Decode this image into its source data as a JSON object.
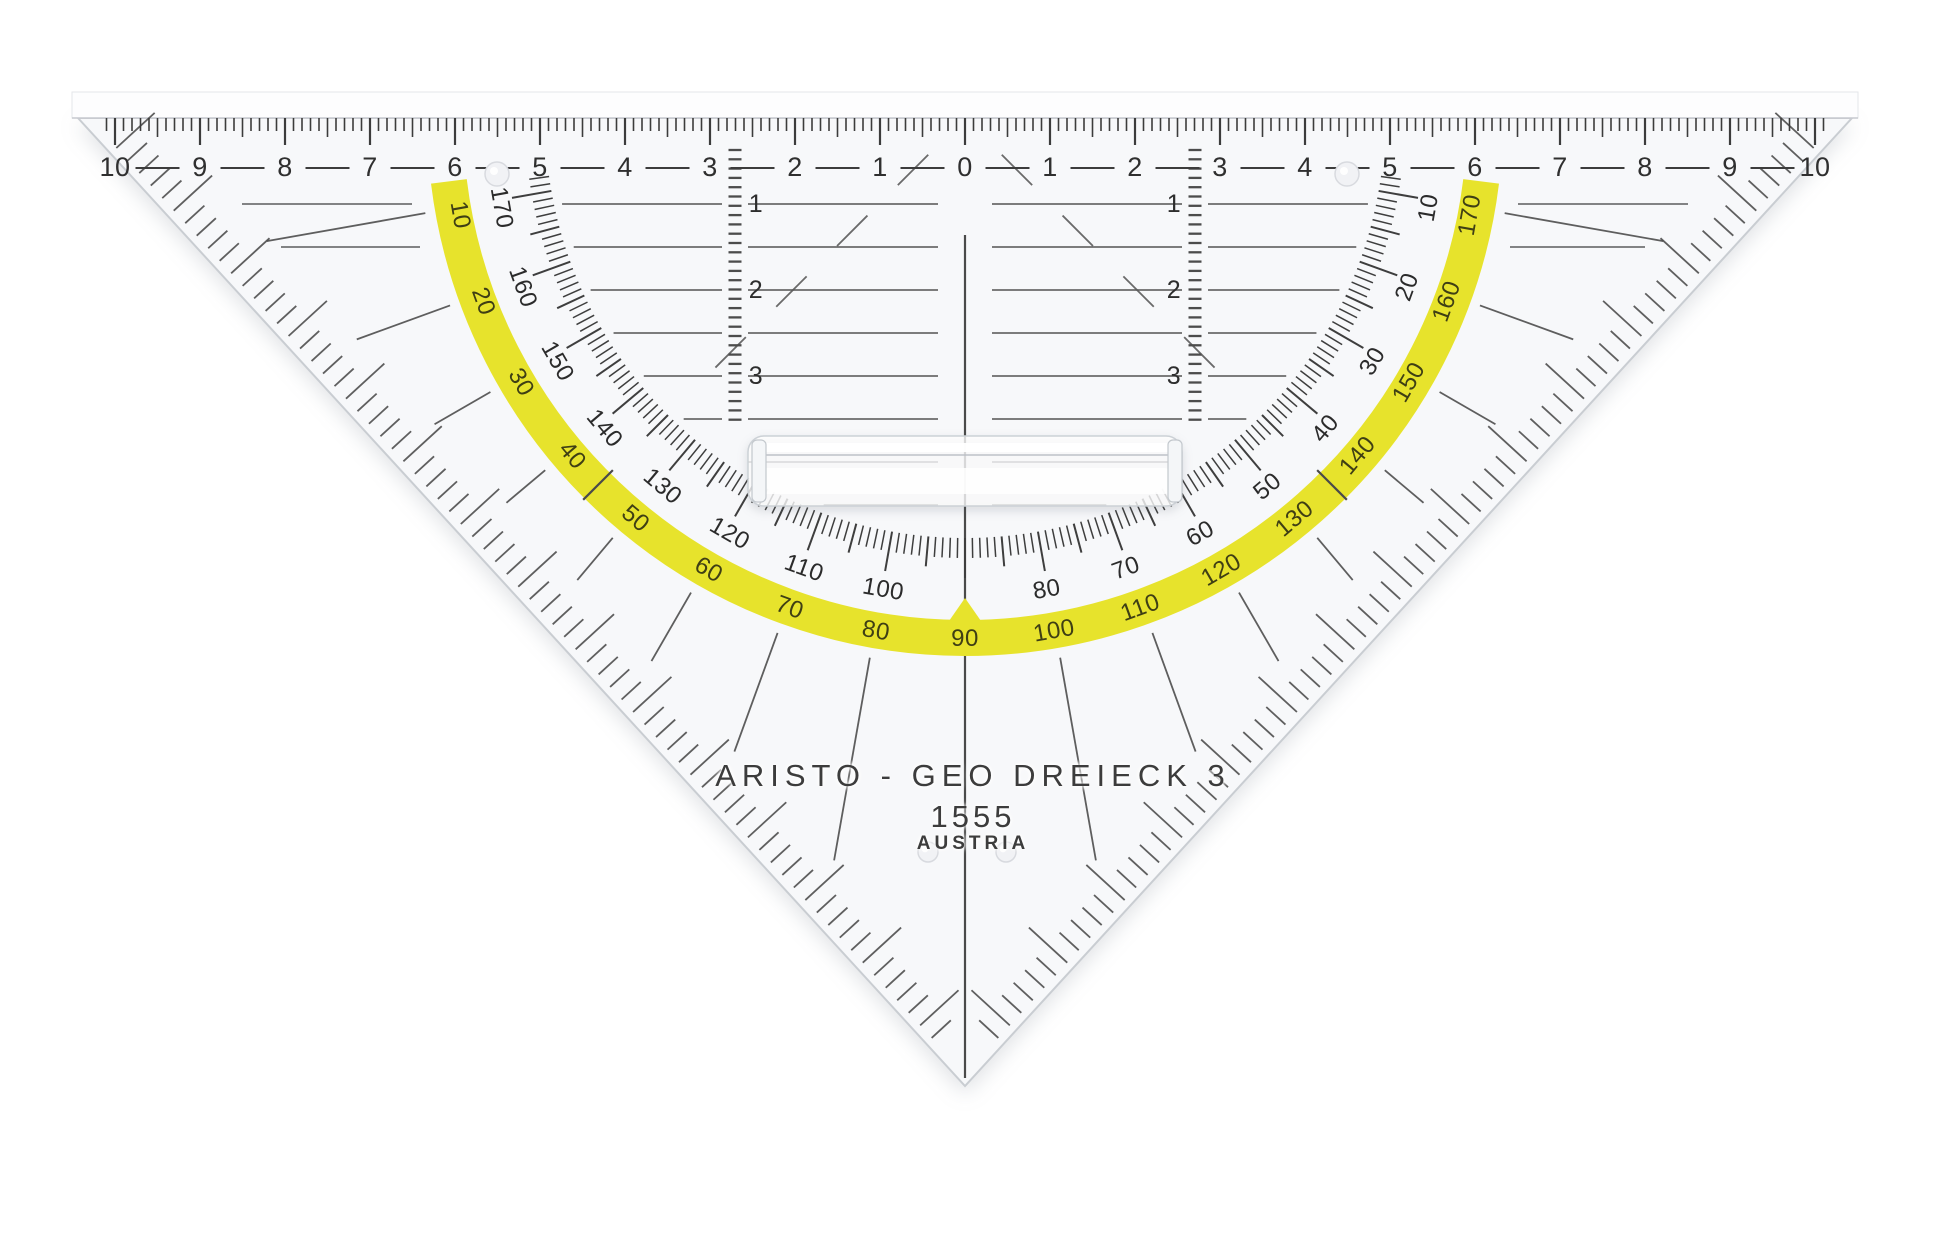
{
  "product": {
    "brand_line": "ARISTO - GEO DREIECK 3",
    "model": "1555",
    "origin": "AUSTRIA"
  },
  "colors": {
    "arc_yellow": "#e7e32c",
    "ink": "#3a3a3a",
    "line": "#5a5a5a",
    "plastic": "#f7f8fa",
    "edge": "#c9cdd2"
  },
  "cm_ruler": {
    "labels": [
      10,
      9,
      8,
      7,
      6,
      5,
      4,
      3,
      2,
      1,
      0,
      1,
      2,
      3,
      4,
      5,
      6,
      7,
      8,
      9,
      10
    ]
  },
  "protractor": {
    "yellow_scale": [
      10,
      20,
      30,
      40,
      50,
      60,
      70,
      80,
      90,
      100,
      110,
      120,
      130,
      140,
      150,
      160,
      170
    ],
    "inner_scale": [
      170,
      160,
      150,
      140,
      130,
      120,
      110,
      100,
      80,
      70,
      60,
      50,
      40,
      30,
      20,
      10
    ],
    "cross_ticks_deg": [
      45,
      135
    ],
    "radial_guides_deg": [
      10,
      20,
      30,
      40,
      50,
      60,
      70,
      80,
      100,
      110,
      120,
      130,
      140,
      150,
      160,
      170
    ]
  },
  "grid": {
    "column_labels": [
      "1",
      "2",
      "3"
    ]
  }
}
